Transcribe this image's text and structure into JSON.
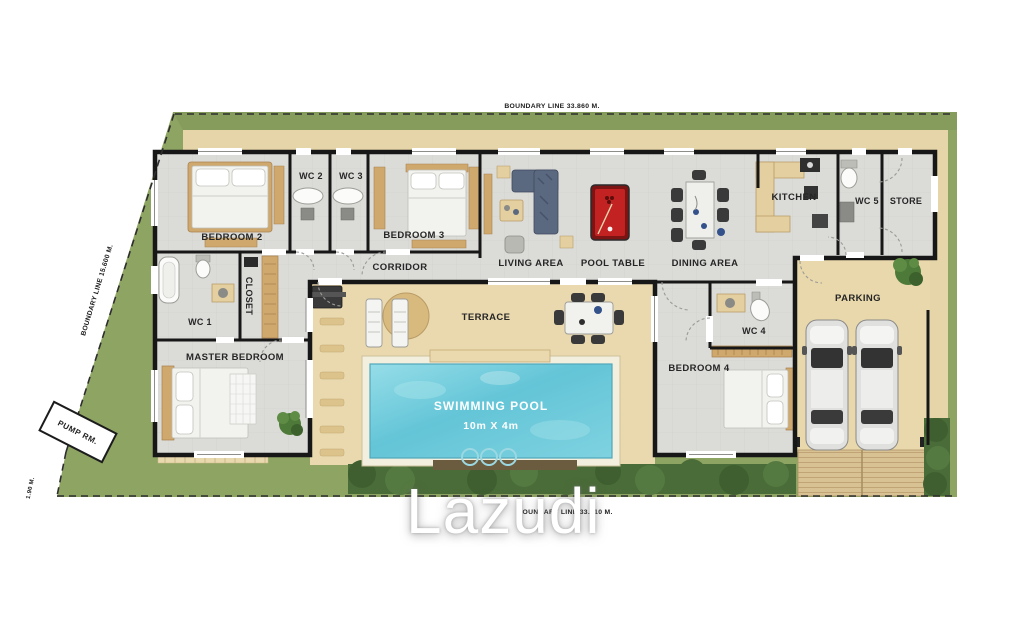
{
  "watermark": "Lazudi",
  "boundaries": {
    "top": "BOUNDARY LINE 33.860 M.",
    "left": "BOUNDARY LINE 15.600 M.",
    "bottom": "BOUNDARY LINE 33.510 M.",
    "corner": "1.90 M."
  },
  "rooms": {
    "bedroom2": "BEDROOM 2",
    "wc2": "WC 2",
    "wc3": "WC 3",
    "bedroom3": "BEDROOM 3",
    "corridor": "CORRIDOR",
    "living": "LIVING AREA",
    "pool_table": "POOL TABLE",
    "dining": "DINING AREA",
    "kitchen": "KITCHEN",
    "wc5": "WC 5",
    "store": "STORE",
    "parking": "PARKING",
    "wc1": "WC 1",
    "closet": "CLOSET",
    "master": "MASTER BEDROOM",
    "terrace": "TERRACE",
    "wc4": "WC 4",
    "bedroom4": "BEDROOM 4",
    "pump": "PUMP RM."
  },
  "pool": {
    "name": "SWIMMING POOL",
    "dimensions": "10m X 4m"
  },
  "colors": {
    "grass": "#8ea463",
    "hedge": "#486a37",
    "sand": "#e9d8ab",
    "floor": "#dbdbd8",
    "wall": "#171717",
    "water": "#6cc8d9",
    "pool_table_red": "#c32222",
    "wood": "#c9a briefcase",
    "wardrobe_wood": "#cfa86e",
    "car_body": "#e0e0de",
    "driveway_wood": "#d8c193"
  }
}
